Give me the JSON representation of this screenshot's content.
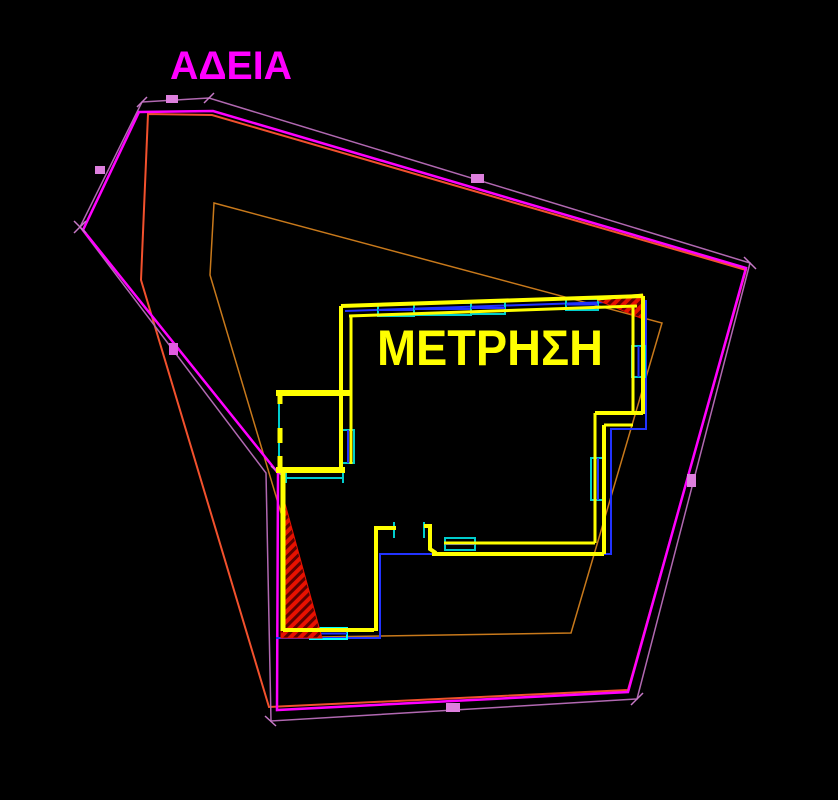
{
  "canvas": {
    "width": 838,
    "height": 800,
    "background": "#000000"
  },
  "labels": {
    "permit": "ΑΔΕΙΑ",
    "measurement": "ΜΕΤΡΗΣΗ"
  },
  "colors": {
    "text_permit": "#FF00FF",
    "text_measurement": "#FFFF00",
    "boundary_main": "#FF00FF",
    "boundary_outer": "#B168B1",
    "offset_salmon": "#F2512D",
    "offset_orange": "#C8791B",
    "wall_yellow": "#FFFF00",
    "window_cyan": "#00CDCD",
    "line_blue": "#2233FF",
    "hatch_fill": "#E81100",
    "hatch_stripe": "#5E0000",
    "tick_violet": "#C779C7",
    "tick_magenta": "#E05CE0",
    "label_box": "#DD7FDD"
  },
  "entities": [
    {
      "n": "offset-polygon-orange",
      "t": "polygon",
      "s": "#C8791B",
      "w": 1.5,
      "i": true,
      "p": [
        [
          214,
          203
        ],
        [
          662,
          323
        ],
        [
          571,
          633
        ],
        [
          318,
          637
        ],
        [
          210,
          275
        ]
      ]
    },
    {
      "n": "offset-polygon-salmon",
      "t": "polygon",
      "s": "#F2512D",
      "w": 2,
      "i": true,
      "p": [
        [
          148,
          114
        ],
        [
          212,
          115
        ],
        [
          746,
          270
        ],
        [
          628,
          690
        ],
        [
          269,
          707
        ],
        [
          141,
          280
        ]
      ]
    },
    {
      "n": "boundary-polygon-outer",
      "t": "polygon",
      "s": "#B168B1",
      "w": 1.5,
      "i": true,
      "p": [
        [
          142,
          102
        ],
        [
          209,
          98
        ],
        [
          750,
          263
        ],
        [
          637,
          699
        ],
        [
          271,
          721
        ],
        [
          266,
          473
        ],
        [
          80,
          227
        ]
      ]
    },
    {
      "n": "boundary-polygon-main",
      "t": "polygon",
      "s": "#FF00FF",
      "w": 2.5,
      "i": true,
      "p": [
        [
          139,
          112
        ],
        [
          213,
          111
        ],
        [
          746,
          268
        ],
        [
          628,
          692
        ],
        [
          277,
          710
        ],
        [
          278,
          473
        ],
        [
          83,
          230
        ]
      ]
    },
    {
      "n": "survey-tick",
      "t": "line",
      "s": "#C779C7",
      "w": 1.5,
      "i": false,
      "p": [
        [
          137,
          107
        ],
        [
          147,
          97
        ]
      ]
    },
    {
      "n": "survey-tick",
      "t": "line",
      "s": "#C779C7",
      "w": 1.5,
      "i": false,
      "p": [
        [
          204,
          103
        ],
        [
          214,
          93
        ]
      ]
    },
    {
      "n": "survey-tick",
      "t": "line",
      "s": "#C779C7",
      "w": 1.5,
      "i": false,
      "p": [
        [
          744,
          257
        ],
        [
          756,
          269
        ]
      ]
    },
    {
      "n": "survey-tick",
      "t": "line",
      "s": "#C779C7",
      "w": 1.5,
      "i": false,
      "p": [
        [
          631,
          705
        ],
        [
          643,
          693
        ]
      ]
    },
    {
      "n": "survey-tick",
      "t": "line",
      "s": "#C779C7",
      "w": 1.5,
      "i": false,
      "p": [
        [
          265,
          716
        ],
        [
          276,
          726
        ]
      ]
    },
    {
      "n": "survey-tick",
      "t": "line",
      "s": "#C779C7",
      "w": 1.5,
      "i": false,
      "p": [
        [
          74,
          221
        ],
        [
          86,
          233
        ]
      ]
    },
    {
      "n": "survey-tick",
      "t": "line",
      "s": "#C779C7",
      "w": 1.5,
      "i": false,
      "p": [
        [
          74,
          233
        ],
        [
          86,
          221
        ]
      ]
    },
    {
      "n": "survey-tick",
      "t": "line",
      "s": "#E05CE0",
      "w": 1.5,
      "i": false,
      "p": [
        [
          271,
          466
        ],
        [
          285,
          478
        ]
      ]
    },
    {
      "n": "dimension-label-box",
      "t": "rect",
      "f": "#DD7FDD",
      "i": false,
      "p": [
        166,
        95,
        12,
        8
      ]
    },
    {
      "n": "dimension-label-box",
      "t": "rect",
      "f": "#DD7FDD",
      "i": false,
      "p": [
        95,
        166,
        10,
        8
      ]
    },
    {
      "n": "dimension-label-box",
      "t": "rect",
      "f": "#DD7FDD",
      "i": false,
      "p": [
        471,
        174,
        13,
        9
      ]
    },
    {
      "n": "dimension-label-box",
      "t": "rect",
      "f": "#E05CE0",
      "i": false,
      "p": [
        169,
        343,
        9,
        12
      ]
    },
    {
      "n": "dimension-label-box",
      "t": "rect",
      "f": "#DD7FDD",
      "i": false,
      "p": [
        446,
        703,
        14,
        9
      ]
    },
    {
      "n": "dimension-label-box",
      "t": "rect",
      "f": "#DD7FDD",
      "i": false,
      "p": [
        687,
        474,
        9,
        13
      ]
    },
    {
      "n": "roof-line-top",
      "t": "line",
      "s": "#2233FF",
      "w": 2,
      "i": true,
      "p": [
        [
          345,
          311
        ],
        [
          639,
          301
        ]
      ]
    },
    {
      "n": "roof-line-right",
      "t": "polyline",
      "s": "#2233FF",
      "w": 2,
      "i": true,
      "p": [
        [
          646,
          300
        ],
        [
          646,
          429
        ],
        [
          611,
          429
        ],
        [
          611,
          554
        ],
        [
          380,
          554
        ],
        [
          380,
          638
        ],
        [
          276,
          638
        ]
      ]
    },
    {
      "n": "window-top-1",
      "t": "window",
      "s": "#00CDCD",
      "c": "#2233FF",
      "w": 2,
      "i": true,
      "p": [
        378,
        304,
        36,
        12
      ]
    },
    {
      "n": "window-top-2",
      "t": "window",
      "s": "#00CDCD",
      "c": "#2233FF",
      "w": 2,
      "i": true,
      "p": [
        414,
        303,
        57,
        12
      ]
    },
    {
      "n": "window-top-3",
      "t": "window",
      "s": "#00CDCD",
      "c": "#2233FF",
      "w": 2,
      "i": true,
      "p": [
        471,
        302,
        34,
        12
      ]
    },
    {
      "n": "window-top-4",
      "t": "window",
      "s": "#00CDCD",
      "c": "#2233FF",
      "w": 2,
      "i": true,
      "p": [
        566,
        299,
        32,
        11
      ]
    },
    {
      "n": "window-left",
      "t": "window",
      "s": "#00CDCD",
      "c": "#2233FF",
      "w": 2,
      "i": true,
      "p": [
        342,
        430,
        12,
        33
      ]
    },
    {
      "n": "window-right-upper",
      "t": "window",
      "s": "#00CDCD",
      "c": "#2233FF",
      "w": 2,
      "i": true,
      "p": [
        632,
        346,
        13,
        31
      ]
    },
    {
      "n": "window-right-lower",
      "t": "window",
      "s": "#00CDCD",
      "c": "#2233FF",
      "w": 2,
      "i": true,
      "p": [
        591,
        458,
        14,
        42
      ]
    },
    {
      "n": "window-bottom-right",
      "t": "window",
      "s": "#00CDCD",
      "c": "#2233FF",
      "w": 2,
      "i": true,
      "p": [
        445,
        538,
        30,
        12
      ]
    },
    {
      "n": "window-bottom-left",
      "t": "window",
      "s": "#00FFFF",
      "c": "#2233FF",
      "w": 2,
      "i": true,
      "p": [
        310,
        628,
        37,
        11
      ]
    },
    {
      "n": "wing-window-left",
      "t": "line",
      "s": "#00CDCD",
      "w": 2,
      "i": true,
      "p": [
        [
          279,
          397
        ],
        [
          279,
          468
        ]
      ]
    },
    {
      "n": "wing-window-bottom",
      "t": "line",
      "s": "#00CDCD",
      "w": 2,
      "i": true,
      "p": [
        [
          287,
          478
        ],
        [
          343,
          478
        ]
      ]
    },
    {
      "n": "wing-window-cap",
      "t": "line",
      "s": "#00CDCD",
      "w": 2,
      "i": false,
      "p": [
        [
          286,
          472
        ],
        [
          286,
          483
        ]
      ]
    },
    {
      "n": "wing-window-cap",
      "t": "line",
      "s": "#00CDCD",
      "w": 2,
      "i": false,
      "p": [
        [
          343,
          472
        ],
        [
          343,
          483
        ]
      ]
    },
    {
      "n": "door-jamb-left",
      "t": "line",
      "s": "#00CDCD",
      "w": 2,
      "i": false,
      "p": [
        [
          394,
          522
        ],
        [
          394,
          538
        ]
      ]
    },
    {
      "n": "door-jamb-right",
      "t": "line",
      "s": "#00CDCD",
      "w": 2,
      "i": false,
      "p": [
        [
          424,
          522
        ],
        [
          424,
          538
        ]
      ]
    },
    {
      "n": "hatch-area-northeast",
      "t": "hatch",
      "i": true,
      "p": [
        [
          597,
          300
        ],
        [
          643,
          295
        ],
        [
          643,
          319
        ]
      ]
    },
    {
      "n": "hatch-area-southwest",
      "t": "hatch",
      "i": true,
      "p": [
        [
          281,
          489
        ],
        [
          281,
          638
        ],
        [
          322,
          638
        ]
      ]
    },
    {
      "n": "wall-top-outer",
      "t": "line",
      "s": "#FFFF00",
      "w": 4,
      "i": true,
      "p": [
        [
          341,
          306
        ],
        [
          643,
          296
        ]
      ]
    },
    {
      "n": "wall-top-inner",
      "t": "line",
      "s": "#FFFF00",
      "w": 3,
      "i": true,
      "p": [
        [
          349,
          316
        ],
        [
          637,
          306
        ]
      ]
    },
    {
      "n": "wall-left-outer",
      "t": "line",
      "s": "#FFFF00",
      "w": 4,
      "i": true,
      "p": [
        [
          341,
          306
        ],
        [
          341,
          473
        ]
      ]
    },
    {
      "n": "wall-left-inner",
      "t": "line",
      "s": "#FFFF00",
      "w": 3,
      "i": true,
      "p": [
        [
          351,
          316
        ],
        [
          351,
          464
        ]
      ]
    },
    {
      "n": "wall-right-outer",
      "t": "line",
      "s": "#FFFF00",
      "w": 4,
      "i": true,
      "p": [
        [
          643,
          296
        ],
        [
          643,
          414
        ]
      ]
    },
    {
      "n": "wall-right-inner",
      "t": "line",
      "s": "#FFFF00",
      "w": 3,
      "i": true,
      "p": [
        [
          633,
          306
        ],
        [
          633,
          413
        ]
      ]
    },
    {
      "n": "wall-step-outer",
      "t": "line",
      "s": "#FFFF00",
      "w": 4,
      "i": true,
      "p": [
        [
          643,
          413
        ],
        [
          595,
          413
        ]
      ]
    },
    {
      "n": "wall-step-inner",
      "t": "line",
      "s": "#FFFF00",
      "w": 3,
      "i": true,
      "p": [
        [
          633,
          425
        ],
        [
          604,
          425
        ]
      ]
    },
    {
      "n": "wall-right2-outer",
      "t": "line",
      "s": "#FFFF00",
      "w": 4,
      "i": true,
      "p": [
        [
          604,
          425
        ],
        [
          604,
          554
        ]
      ]
    },
    {
      "n": "wall-right2-inner",
      "t": "line",
      "s": "#FFFF00",
      "w": 3,
      "i": true,
      "p": [
        [
          595,
          413
        ],
        [
          595,
          543
        ]
      ]
    },
    {
      "n": "wall-bottomright-outer",
      "t": "line",
      "s": "#FFFF00",
      "w": 4,
      "i": true,
      "p": [
        [
          604,
          554
        ],
        [
          432,
          554
        ]
      ]
    },
    {
      "n": "wall-bottomright-inner",
      "t": "line",
      "s": "#FFFF00",
      "w": 3,
      "i": true,
      "p": [
        [
          595,
          543
        ],
        [
          444,
          543
        ]
      ]
    },
    {
      "n": "interior-wall-left",
      "t": "polyline",
      "s": "#FFFF00",
      "w": 4,
      "i": true,
      "p": [
        [
          396,
          528
        ],
        [
          376,
          528
        ],
        [
          376,
          631
        ]
      ]
    },
    {
      "n": "interior-wall-step",
      "t": "polyline",
      "s": "#FFFF00",
      "w": 4,
      "i": true,
      "p": [
        [
          424,
          526
        ],
        [
          430,
          526
        ],
        [
          430,
          549
        ],
        [
          436,
          553
        ]
      ]
    },
    {
      "n": "wall-bottomleft-inner",
      "t": "line",
      "s": "#FFFF00",
      "w": 4,
      "i": true,
      "p": [
        [
          283,
          630
        ],
        [
          374,
          630
        ]
      ]
    },
    {
      "n": "wall-lowerleft-outer",
      "t": "line",
      "s": "#FFFF00",
      "w": 5,
      "i": true,
      "p": [
        [
          283,
          471
        ],
        [
          283,
          631
        ]
      ]
    },
    {
      "n": "wing-wall-top",
      "t": "line",
      "s": "#FFFF00",
      "w": 6,
      "i": true,
      "p": [
        [
          276,
          393
        ],
        [
          350,
          393
        ]
      ]
    },
    {
      "n": "wing-wall-bottom",
      "t": "line",
      "s": "#FFFF00",
      "w": 6,
      "i": true,
      "p": [
        [
          276,
          470
        ],
        [
          345,
          470
        ]
      ]
    },
    {
      "n": "wing-wall-stub",
      "t": "line",
      "s": "#FFFF00",
      "w": 5,
      "i": false,
      "p": [
        [
          280,
          395
        ],
        [
          280,
          404
        ]
      ]
    },
    {
      "n": "wing-wall-stub",
      "t": "line",
      "s": "#FFFF00",
      "w": 5,
      "i": false,
      "p": [
        [
          280,
          428
        ],
        [
          280,
          443
        ]
      ]
    },
    {
      "n": "wing-wall-stub",
      "t": "line",
      "s": "#FFFF00",
      "w": 5,
      "i": false,
      "p": [
        [
          280,
          456
        ],
        [
          280,
          469
        ]
      ]
    },
    {
      "n": "wall-over-hatch",
      "t": "line",
      "s": "#FFFF00",
      "w": 3,
      "i": false,
      "p": [
        [
          597,
          299
        ],
        [
          643,
          295
        ]
      ]
    }
  ]
}
